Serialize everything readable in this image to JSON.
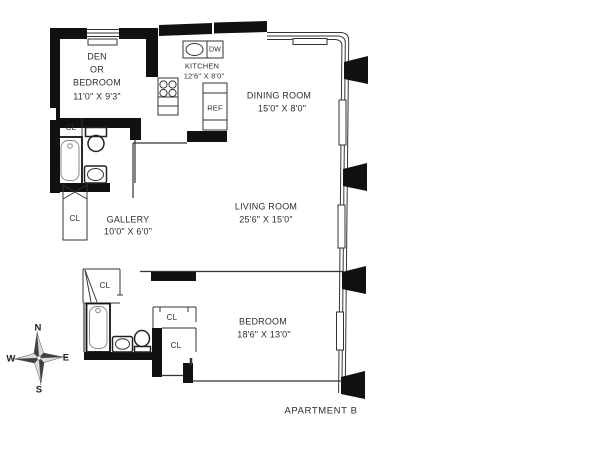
{
  "apartment_label": "APARTMENT B",
  "rooms": {
    "den": {
      "line1": "DEN",
      "line2": "OR",
      "line3": "BEDROOM",
      "dims": "11'0\" X 9'3\""
    },
    "kitchen": {
      "name": "KITCHEN",
      "dims": "12'6\" X 8'0\""
    },
    "dining_room": {
      "name": "DINING ROOM",
      "dims": "15'0\" X 8'0\""
    },
    "living_room": {
      "name": "LIVING ROOM",
      "dims": "25'6\" X 15'0\""
    },
    "gallery": {
      "name": "GALLERY",
      "dims": "10'0\" X 6'0\""
    },
    "bedroom": {
      "name": "BEDROOM",
      "dims": "18'6\" X 13'0\""
    }
  },
  "fixtures": {
    "closet": "CL",
    "dishwasher": "DW",
    "refrigerator": "REF"
  },
  "compass": {
    "north": "N",
    "south": "S",
    "east": "E",
    "west": "W"
  },
  "colors": {
    "wall": "#111111",
    "line": "#333333",
    "text": "#2d2d2d"
  }
}
